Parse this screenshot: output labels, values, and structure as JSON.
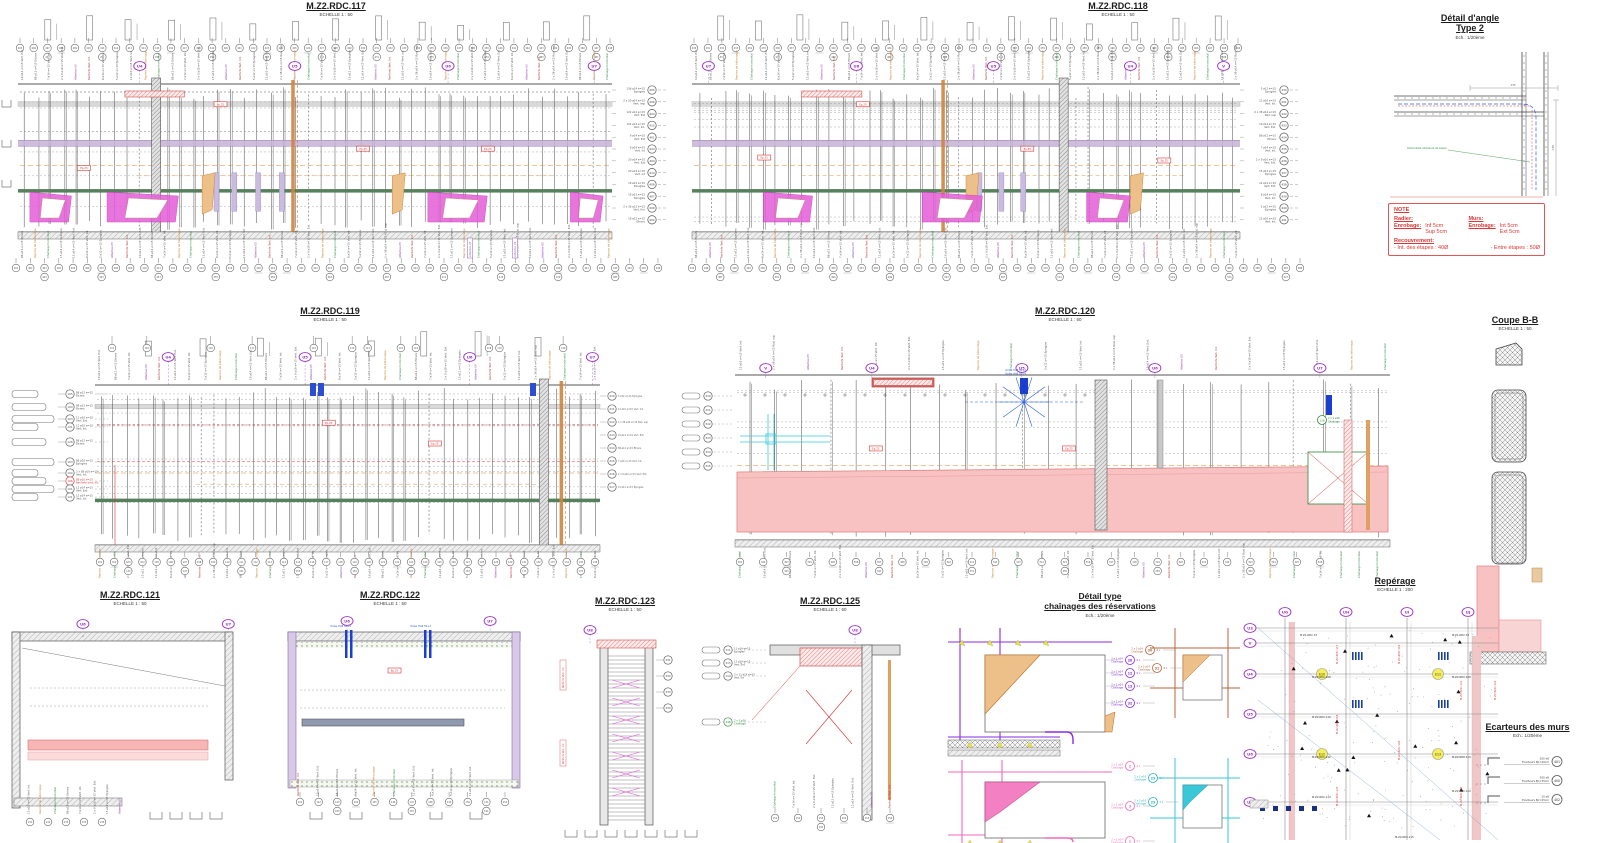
{
  "sheet": {
    "bg": "#ffffff"
  },
  "colors": {
    "line": "#4a4a4a",
    "purple_band": "#c6b3d6",
    "green_band": "#57815d",
    "pink_fill": "#f8c2c2",
    "pink_border": "#e08080",
    "magenta": "#e45ed8",
    "orange": "#d98a32",
    "red": "#d93535",
    "blue": "#2b5fd9",
    "cyan": "#3ac8d8",
    "grid_purple": "#9b30c9",
    "tan": "#eec089",
    "yellow": "#f5ef5a",
    "brown": "#b5643c",
    "pink_detail": "#f06ab8",
    "green": "#2e8b3e"
  },
  "panels": {
    "p117": {
      "title": "M.Z2.RDC.117",
      "scale": "ECHELLE 1 : 50"
    },
    "p118": {
      "title": "M.Z2.RDC.118",
      "scale": "ECHELLE 1 : 50"
    },
    "p119": {
      "title": "M.Z2.RDC.119",
      "scale": "ECHELLE 1 : 50"
    },
    "p120": {
      "title": "M.Z2.RDC.120",
      "scale": "ECHELLE 1 : 50"
    },
    "p121": {
      "title": "M.Z2.RDC.121",
      "scale": "ECHELLE 1 : 50"
    },
    "p122": {
      "title": "M.Z2.RDC.122",
      "scale": "ECHELLE 1 : 50"
    },
    "p123": {
      "title": "M.Z2.RDC.123",
      "scale": "ECHELLE 1 : 50"
    },
    "p125": {
      "title": "M.Z2.RDC.125",
      "scale": "ECHELLE 1 : 50"
    }
  },
  "detail_angle": {
    "title_line1": "Détail d'angle",
    "title_line2": "Type 2",
    "scale": "Ech.: 1/20ème",
    "annotation": "Horizontale intérieure de liaison",
    "dim1": "135",
    "dim2": "135"
  },
  "note": {
    "heading": "NOTE",
    "radier_label": "Radier:",
    "enrobage_label": "Enrobage:",
    "radier_values": "Inf   5cm\nSup 5cm",
    "murs_label": "Murs:",
    "murs_enrobage_label": "Enrobage:",
    "murs_values": "Int   5cm\nExt 5cm",
    "recouvrement_label": "Recouvrement:",
    "recouvrement_int": "- Int. des étapes : 40Ø",
    "recouvrement_entre": "- Entre étapes : 50Ø"
  },
  "coupe": {
    "title": "Coupe B-B",
    "scale": "ECHELLE 1 : 50"
  },
  "chainages": {
    "title_line1": "Détail type",
    "title_line2": "chaînages des réservations",
    "scale": "Ech.: 1/20ème",
    "purple_marks": [
      {
        "num": "28",
        "pre": "2 x 1 ø14",
        "sub": "Chaînage",
        "mult": "9 x"
      },
      {
        "num": "12",
        "pre": "2 x 1 ø14",
        "sub": "Chaînage",
        "mult": "9 x"
      },
      {
        "num": "13",
        "pre": "2 x 1 ø14",
        "sub": "Chaînage",
        "mult": "9 x"
      },
      {
        "num": "32",
        "pre": "2 x 1 ø14",
        "sub": "Chaînage",
        "mult": "9 x"
      }
    ],
    "brown_marks": [
      {
        "num": "30",
        "pre": "2 x 2 ø14",
        "sub": "Chaînage",
        "mult": "8 x"
      },
      {
        "num": "31",
        "pre": "2 x 2 ø14",
        "sub": "Chaînage",
        "mult": "8 x"
      }
    ],
    "magenta_marks": [
      {
        "num": "2",
        "pre": "2 x 1 ø14",
        "sub": "Chaînage",
        "mult": "9 x"
      },
      {
        "num": "3",
        "pre": "2 x 2 ø14",
        "sub": "Chaînage",
        "mult": "9 x"
      },
      {
        "num": "1",
        "pre": "2 x 1 ø14",
        "sub": "Chaînage",
        "mult": "9 x"
      }
    ],
    "cyan_marks": [
      {
        "num": "29",
        "pre": "2 x 2 ø14",
        "sub": "Chaînage",
        "mult": "2 x"
      },
      {
        "num": "29",
        "pre": "2 x 2 ø14",
        "sub": "Chaînage",
        "mult": "2 x"
      }
    ]
  },
  "reperage": {
    "title": "Repérage",
    "scale": "ECHELLE 1 : 200",
    "col_markers": [
      "UG",
      "UH",
      "UI",
      "UJ"
    ],
    "row_markers": [
      "U3",
      "V",
      "U4",
      "U5",
      "U6",
      "U7"
    ],
    "zone_labels": [
      "M.Z1.RDC.33",
      "M.Z1.RDC.34",
      "M.Z2.RDC.108",
      "M.Z2.RDC.109",
      "M.Z2.RDC.110",
      "M.Z2.RDC.112",
      "M.Z2.RDC.113",
      "M.Z2.RDC.114",
      "M.Z2.RDC.115",
      "M.Z2.RDC.124"
    ],
    "red_labels": [
      "M.Z2.RDC.117",
      "M.Z2.RDC.118",
      "M.Z2.RDC.119",
      "M.Z2.RDC.120",
      "M.Z2.RDC.121",
      "M.Z2.RDC.122",
      "M.Z2.RDC.123",
      "M.Z2.RDC.125"
    ],
    "yellow_marks": [
      "E10",
      "E11",
      "E12",
      "E13"
    ]
  },
  "ecarteurs": {
    "title": "Ecarteurs des murs",
    "scale": "Ech.: 1/20ème",
    "items": [
      {
        "qty": "200 e8",
        "label": "Ecarteurs Ep=40cm",
        "mark": "401"
      },
      {
        "qty": "500 e8",
        "label": "Ecarteurs Ep=35cm",
        "mark": "400"
      },
      {
        "qty": "10 e8",
        "label": "Ecarteurs Ep=25cm",
        "mark": "402"
      }
    ]
  },
  "callouts": {
    "right117": [
      {
        "qty": "136 ø14 e=15",
        "type": "Epingles",
        "mark": "405"
      },
      {
        "qty": "2 x 20 ø14 e=15",
        "type": "Vert. Imp",
        "mark": "406"
      },
      {
        "qty": "122 ø14 e=15",
        "type": "Vert. Ext",
        "mark": "404"
      },
      {
        "qty": "122 ø14 e=15",
        "type": "Vert. Int.",
        "mark": "415"
      },
      {
        "qty": "9 ø14 e=15",
        "type": "Vert. Ext",
        "mark": "401"
      },
      {
        "qty": "9 ø14 e=15",
        "type": "Vert. Int",
        "mark": "424"
      },
      {
        "qty": "20 ø14 e=15",
        "type": "Vert. Ext",
        "mark": "403"
      },
      {
        "qty": "20 ø14 e=15",
        "type": "Vert. Int",
        "mark": "414"
      },
      {
        "qty": "19 ø12 e=15",
        "type": "Epingles",
        "mark": "408"
      },
      {
        "qty": "19 ø12 e=15",
        "type": "Epingles",
        "mark": "407"
      },
      {
        "qty": "2 x 36 ø12 e=15",
        "type": "Vert. Hor",
        "mark": "409"
      },
      {
        "qty": "19 ø12 e=15",
        "type": "Etriers",
        "mark": "402"
      }
    ],
    "left119": [
      {
        "qty": "88 ø12 e=15",
        "type": "Etriers",
        "mark": "105"
      },
      {
        "qty": "88 ø12 e=15",
        "type": "Etriers",
        "mark": "104"
      },
      {
        "qty": "11 ø10 e=10",
        "type": "Vert. Ext.",
        "mark": "103"
      },
      {
        "qty": "11 ø10 e=10",
        "type": "Vert. Int.",
        "mark": "121"
      },
      {
        "qty": "88 ø12 e=15",
        "type": "Etriers",
        "mark": "128"
      },
      {
        "qty": "88 ø10 e=15",
        "type": "Epingles",
        "mark": "103"
      },
      {
        "qty": "2 x 88 ø10 e=15",
        "type": "Vert. Int.",
        "mark": "102"
      },
      {
        "qty": "88 ø10 e=15",
        "type": "Renforts Vert. Int.",
        "mark": "106",
        "red": true
      },
      {
        "qty": "12 ø14 e=15",
        "type": "Vert. Ext.",
        "mark": "101"
      },
      {
        "qty": "12 ø14 e=15",
        "type": "Vert. Int.",
        "mark": "121"
      }
    ],
    "left125": [
      {
        "qty": "11 ø14 e=15",
        "type": "Epingles",
        "mark": "311"
      },
      {
        "qty": "11 ø14 e=15",
        "type": "Vert. Ext",
        "mark": "315"
      },
      {
        "qty": "2 x 11 ø14 e=15",
        "type": "Vert. Int",
        "mark": "119"
      },
      {
        "qty": "2 x 2 ø16",
        "type": "Chaînage",
        "mark": "348",
        "green": true
      }
    ],
    "green116": {
      "qty": "2 x 2 ø16",
      "type": "Chaînage",
      "mark": "116"
    }
  },
  "rebar_samples": [
    [
      "5 ø12 e=15",
      "Epingles"
    ],
    [
      "12 ø10 e=15",
      "Vert. Int."
    ],
    [
      "2 x 38 ø14 e=15",
      "Rad. sup"
    ],
    [
      "10 ø14 e=15",
      "Vert. Ext."
    ],
    [
      "88 ø12 e=15",
      "Etriers"
    ],
    [
      "7 ø14 e=15",
      "Vert. Int."
    ],
    [
      "2 x 9 ø10 e=15",
      "Vert. Ext."
    ],
    [
      "15 ø12 e=15",
      "Epingles"
    ],
    [
      "12 ø14 e=15",
      "Vert. Ext."
    ],
    [
      "8 ø14 e=15",
      "Vert. Int."
    ]
  ],
  "special_labels": {
    "blue": "Voiles HA8 50+4",
    "red": "Renforts Vert. Int.",
    "purple": "Attentes U5",
    "green": "Chaînage horizontal",
    "orange": "Reprise de bétonnage"
  },
  "misc": {
    "red_box_text": "Ep.25"
  },
  "grid_bubbles": {
    "p117": [
      {
        "l": "U4",
        "fx": 0.205
      },
      {
        "l": "U5",
        "fx": 0.466
      },
      {
        "l": "U6",
        "fx": 0.724
      },
      {
        "l": "U7",
        "fx": 0.97
      }
    ],
    "p118": [
      {
        "l": "U7",
        "fx": 0.03
      },
      {
        "l": "U6",
        "fx": 0.3
      },
      {
        "l": "U5",
        "fx": 0.55
      },
      {
        "l": "U4",
        "fx": 0.8
      },
      {
        "l": "V",
        "fx": 0.97
      }
    ],
    "p119": [
      {
        "l": "U4",
        "fx": 0.145
      },
      {
        "l": "U5",
        "fx": 0.416
      },
      {
        "l": "U6",
        "fx": 0.742
      },
      {
        "l": "U7",
        "fx": 0.985
      }
    ],
    "p120": [
      {
        "l": "V",
        "fx": 0.047
      },
      {
        "l": "U4",
        "fx": 0.209
      },
      {
        "l": "U5",
        "fx": 0.438
      },
      {
        "l": "U6",
        "fx": 0.641
      },
      {
        "l": "U7",
        "fx": 0.893
      }
    ],
    "p121": [
      {
        "l": "U6",
        "fx": 0.318
      },
      {
        "l": "U7",
        "fx": 0.97
      }
    ],
    "p122": [
      {
        "l": "U6",
        "fx": 0.248
      },
      {
        "l": "U7",
        "fx": 0.87
      }
    ],
    "p123": [
      {
        "l": "U8",
        "fx": 0.2
      }
    ],
    "p125": [
      {
        "l": "U8",
        "fx": 0.75
      }
    ]
  }
}
